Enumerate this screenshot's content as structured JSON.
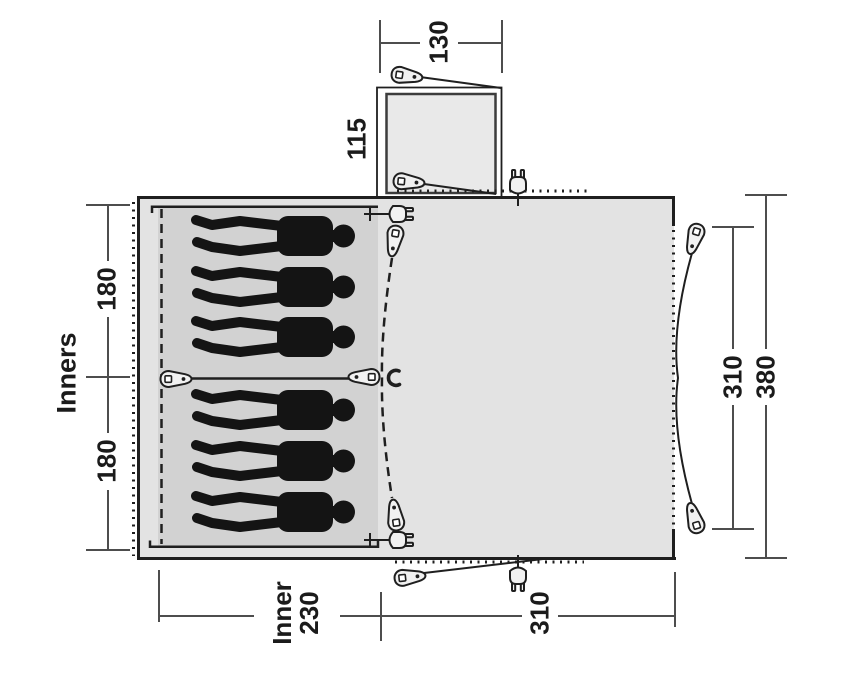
{
  "figure": {
    "kind": "tent floor plan diagram",
    "labels": {
      "porch_width": "130",
      "porch_depth": "115",
      "inners_caption": "Inners",
      "sleeping_section_top": "180",
      "sleeping_section_bottom": "180",
      "side_inner_width": "310",
      "side_total_width": "380",
      "inner_length_word": "Inner",
      "inner_length_value": "230",
      "living_area_length": "310"
    },
    "icons": {
      "peg": "tent-peg-icon",
      "plug": "power-plug-icon",
      "clip": "clip-icon",
      "person": "person-silhouette"
    },
    "colors": {
      "background": "#ffffff",
      "tent_fill": "#e3e3e3",
      "inner_fill": "#d2d2d2",
      "porch_fill": "#e9e9e9",
      "outline": "#1f1f1f",
      "dim_line": "#4d4d4d",
      "silhouette": "#141414"
    }
  }
}
